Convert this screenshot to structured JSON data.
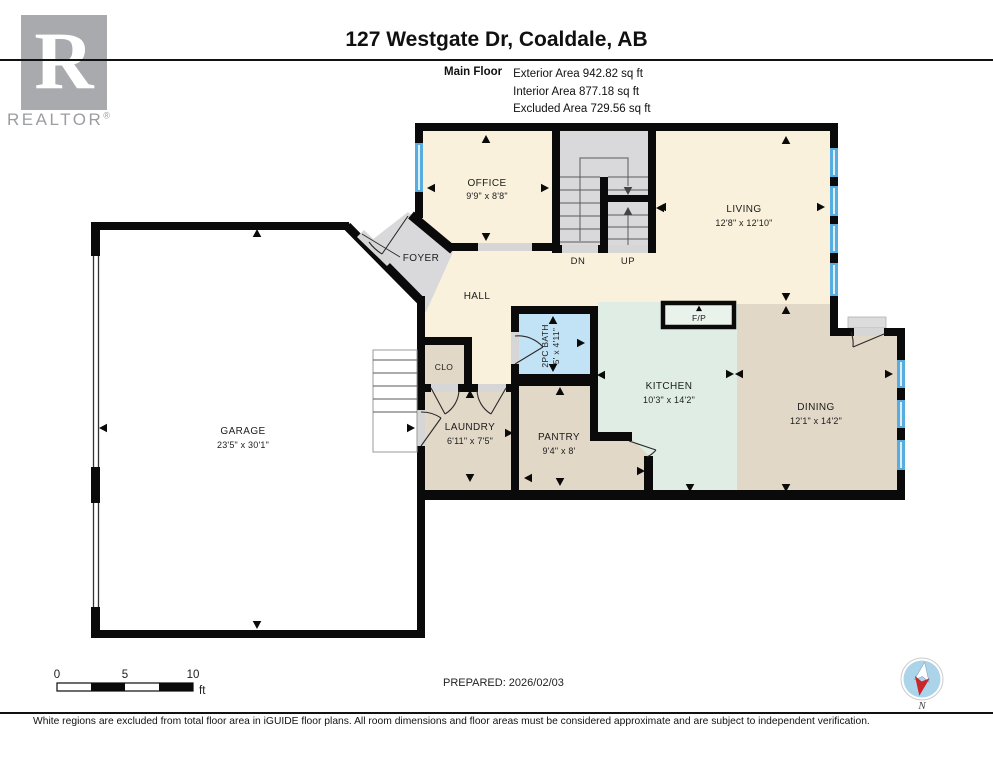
{
  "header": {
    "title": "127 Westgate Dr, Coaldale, AB",
    "floor_label": "Main Floor",
    "area_lines": [
      "Exterior Area 942.82 sq ft",
      "Interior Area 877.18 sq ft",
      "Excluded Area 729.56 sq ft"
    ]
  },
  "logo": {
    "letter": "R",
    "brand": "REALTOR",
    "registered": "®"
  },
  "rooms": {
    "office": {
      "name": "OFFICE",
      "dims": "9'9\" x 8'8\""
    },
    "living": {
      "name": "LIVING",
      "dims": "12'8\" x 12'10\""
    },
    "foyer": {
      "name": "FOYER"
    },
    "hall": {
      "name": "HALL"
    },
    "clo": {
      "name": "CLO"
    },
    "bath": {
      "name": "2PC BATH",
      "dims": "5' x 4'11\""
    },
    "kitchen": {
      "name": "KITCHEN",
      "dims": "10'3\" x 14'2\""
    },
    "dining": {
      "name": "DINING",
      "dims": "12'1\" x 14'2\""
    },
    "laundry": {
      "name": "LAUNDRY",
      "dims": "6'11\" x 7'5\""
    },
    "pantry": {
      "name": "PANTRY",
      "dims": "9'4\" x 8'"
    },
    "garage": {
      "name": "GARAGE",
      "dims": "23'5\" x 30'1\""
    }
  },
  "stairs": {
    "down": "DN",
    "up": "UP"
  },
  "fireplace": {
    "label": "F/P"
  },
  "scale_bar": {
    "tick_0": "0",
    "tick_5": "5",
    "tick_10": "10",
    "unit": "ft"
  },
  "prepared": "PREPARED: 2026/02/03",
  "compass": {
    "north_label": "N"
  },
  "footer_note": "White regions are excluded from total floor area in iGUIDE floor plans. All room dimensions and floor areas must be considered approximate and are subject to independent verification.",
  "colors": {
    "room_cream": "#FAF1DC",
    "room_gray": "#D9D9DB",
    "room_tan": "#E2D8C7",
    "room_mint": "#DFEDE5",
    "room_bath_blue": "#C2E3F5",
    "opening_gray": "#D6D6D6",
    "window_blue": "#58ADE0",
    "wall_black": "#0A0A0A",
    "compass_blue": "#ABD4EB",
    "compass_red": "#C9252B",
    "logo_gray": "#A8AAAD"
  }
}
